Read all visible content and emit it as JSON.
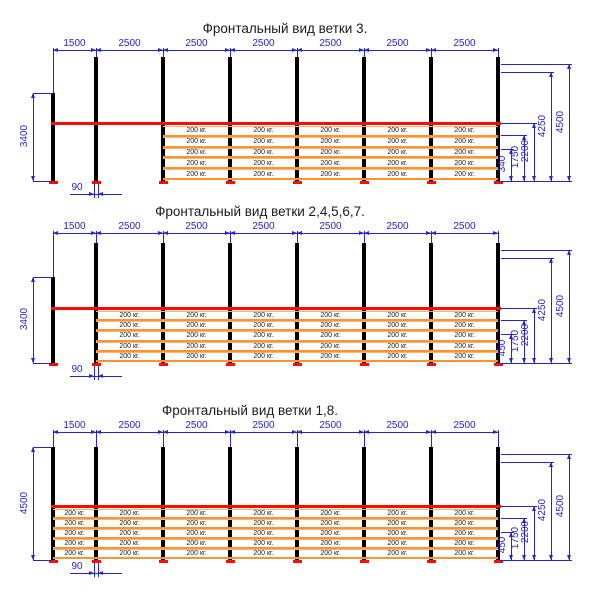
{
  "colors": {
    "dimension_blue": "#2424d0",
    "beam_red": "#ff0a00",
    "shelf_orange_thick": "#ff9232",
    "shelf_orange_thin": "#ffb36b",
    "upright_black": "#000000",
    "base_plate_red": "#ff0a00",
    "text_dark": "#1a1a1a"
  },
  "views": [
    {
      "title": "Фронтальный вид ветки 3.",
      "bay_dims": [
        "1500",
        "2500",
        "2500",
        "2500",
        "2500",
        "2500",
        "2500"
      ],
      "left_height_dim": "3400",
      "right_dims": {
        "shelf_low": "340",
        "shelf_first": "1750",
        "beam": "2200",
        "frame_inner": "4250",
        "frame": "4500"
      },
      "base_gap_dim": "90",
      "shelf_load_label": "200 кг.",
      "shelf_levels": 5,
      "first_shelved_bay": 3
    },
    {
      "title": "Фронтальный вид ветки 2,4,5,6,7.",
      "bay_dims": [
        "1500",
        "2500",
        "2500",
        "2500",
        "2500",
        "2500",
        "2500"
      ],
      "left_height_dim": "3400",
      "right_dims": {
        "shelf_low": "450",
        "shelf_first": "1750",
        "beam": "2200",
        "frame_inner": "4250",
        "frame": "4500"
      },
      "base_gap_dim": "90",
      "shelf_load_label": "200 кг.",
      "shelf_levels": 5,
      "first_shelved_bay": 2
    },
    {
      "title": "Фронтальный вид ветки 1,8.",
      "bay_dims": [
        "1500",
        "2500",
        "2500",
        "2500",
        "2500",
        "2500",
        "2500"
      ],
      "left_height_dim": "4500",
      "right_dims": {
        "shelf_low": "450",
        "shelf_first": "1750",
        "beam": "2200",
        "frame_inner": "4250",
        "frame": "4500"
      },
      "base_gap_dim": "90",
      "shelf_load_label": "200 кг.",
      "shelf_levels": 5,
      "first_shelved_bay": 1
    }
  ]
}
